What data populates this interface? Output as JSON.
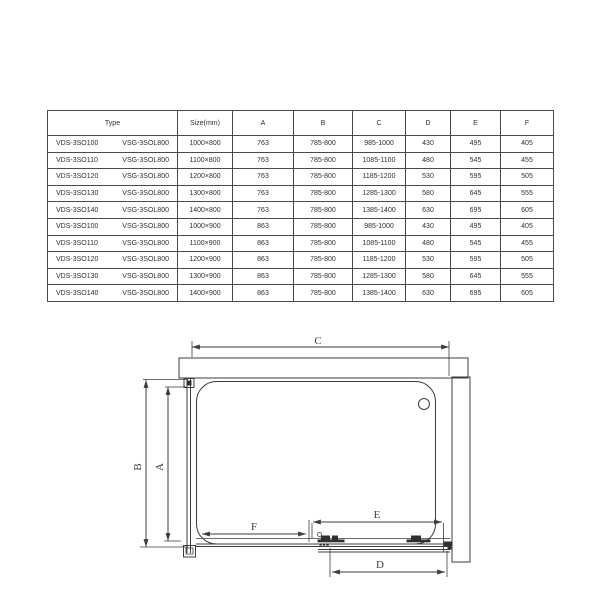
{
  "table": {
    "header": {
      "type": "Type",
      "size": "Size(mm)",
      "a": "A",
      "b": "B",
      "c": "C",
      "d": "D",
      "e": "E",
      "f": "F"
    },
    "rows": [
      {
        "type1": "VDS-3SO100",
        "type2": "VSG-3SOL800",
        "size": "1000×800",
        "a": "763",
        "b": "785-800",
        "c": "985-1000",
        "d": "430",
        "e": "495",
        "f": "405"
      },
      {
        "type1": "VDS-3SO110",
        "type2": "VSG-3SOL800",
        "size": "1100×800",
        "a": "763",
        "b": "785-800",
        "c": "1085-1100",
        "d": "480",
        "e": "545",
        "f": "455"
      },
      {
        "type1": "VDS-3SO120",
        "type2": "VSG-3SOL800",
        "size": "1200×800",
        "a": "763",
        "b": "785-800",
        "c": "1185-1200",
        "d": "530",
        "e": "595",
        "f": "505"
      },
      {
        "type1": "VDS-3SO130",
        "type2": "VSG-3SOL800",
        "size": "1300×800",
        "a": "763",
        "b": "785-800",
        "c": "1285-1300",
        "d": "580",
        "e": "645",
        "f": "555"
      },
      {
        "type1": "VDS-3SO140",
        "type2": "VSG-3SOL800",
        "size": "1400×800",
        "a": "763",
        "b": "785-800",
        "c": "1385-1400",
        "d": "630",
        "e": "695",
        "f": "605"
      },
      {
        "type1": "VDS-3SO100",
        "type2": "VSG-3SOL800",
        "size": "1000×900",
        "a": "863",
        "b": "785-800",
        "c": "985-1000",
        "d": "430",
        "e": "495",
        "f": "405"
      },
      {
        "type1": "VDS-3SO110",
        "type2": "VSG-3SOL800",
        "size": "1100×900",
        "a": "863",
        "b": "785-800",
        "c": "1085-1100",
        "d": "480",
        "e": "545",
        "f": "455"
      },
      {
        "type1": "VDS-3SO120",
        "type2": "VSG-3SOL800",
        "size": "1200×900",
        "a": "863",
        "b": "785-800",
        "c": "1185-1200",
        "d": "530",
        "e": "595",
        "f": "505"
      },
      {
        "type1": "VDS-3SO130",
        "type2": "VSG-3SOL800",
        "size": "1300×900",
        "a": "863",
        "b": "785-800",
        "c": "1285-1300",
        "d": "580",
        "e": "645",
        "f": "555"
      },
      {
        "type1": "VDS-3SO140",
        "type2": "VSG-3SOL800",
        "size": "1400×900",
        "a": "863",
        "b": "785-800",
        "c": "1385-1400",
        "d": "630",
        "e": "695",
        "f": "605"
      }
    ]
  },
  "diagram": {
    "labels": {
      "c": "C",
      "b": "B",
      "a": "A",
      "f": "F",
      "e": "E",
      "d": "D"
    }
  },
  "colors": {
    "line": "#3d3d3d",
    "text": "#2f2f2f",
    "background": "#ffffff"
  }
}
